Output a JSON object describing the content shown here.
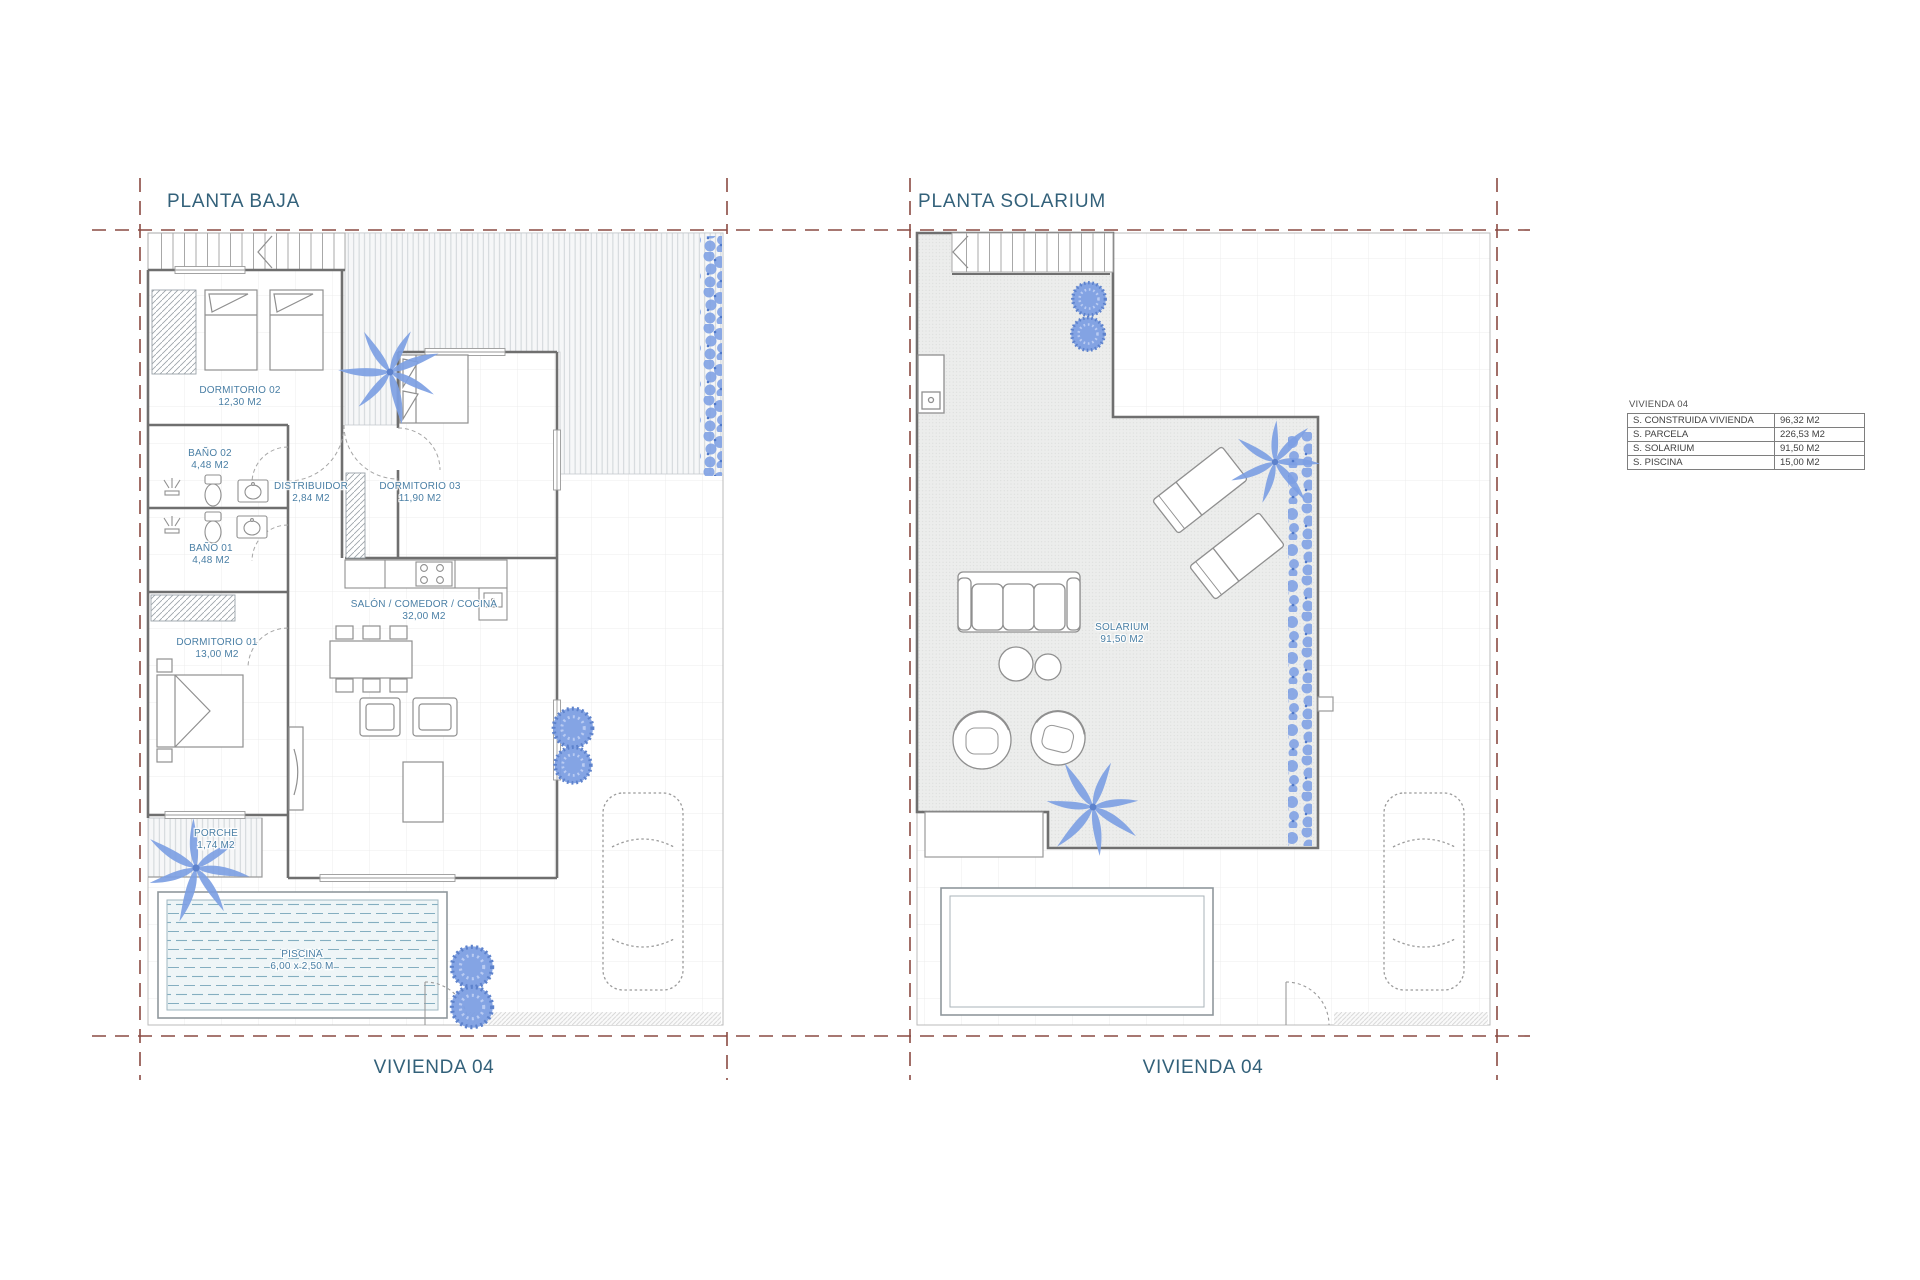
{
  "left_plan": {
    "title": "PLANTA BAJA",
    "footer": "VIVIENDA 04",
    "rooms": [
      {
        "name": "DORMITORIO 02",
        "area": "12,30 M2"
      },
      {
        "name": "BAÑO 02",
        "area": "4,48 M2"
      },
      {
        "name": "BAÑO 01",
        "area": "4,48 M2"
      },
      {
        "name": "DISTRIBUIDOR",
        "area": "2,84 M2"
      },
      {
        "name": "DORMITORIO 03",
        "area": "11,90 M2"
      },
      {
        "name": "DORMITORIO 01",
        "area": "13,00 M2"
      },
      {
        "name": "SALÓN / COMEDOR / COCINA",
        "area": "32,00 M2"
      },
      {
        "name": "PORCHE",
        "area": "1,74 M2"
      },
      {
        "name": "PISCINA",
        "area": "6,00 x 2,50 M"
      }
    ]
  },
  "right_plan": {
    "title": "PLANTA SOLARIUM",
    "footer": "VIVIENDA 04",
    "rooms": [
      {
        "name": "SOLARIUM",
        "area": "91,50 M2"
      }
    ]
  },
  "summary_table": {
    "title": "VIVIENDA 04",
    "rows": [
      {
        "label": "S. CONSTRUIDA VIVIENDA",
        "value": "96,32 M2"
      },
      {
        "label": "S. PARCELA",
        "value": "226,53 M2"
      },
      {
        "label": "S. SOLARIUM",
        "value": "91,50 M2"
      },
      {
        "label": "S. PISCINA",
        "value": "15,00 M2"
      }
    ]
  },
  "colors": {
    "title_text": "#33617a",
    "room_label_text": "#4a7fa5",
    "parcel_boundary": "#8a4a42",
    "vegetation": "#7d9fe3",
    "pool_stripe": "#84aec0",
    "walls": "#6f6f6f"
  }
}
